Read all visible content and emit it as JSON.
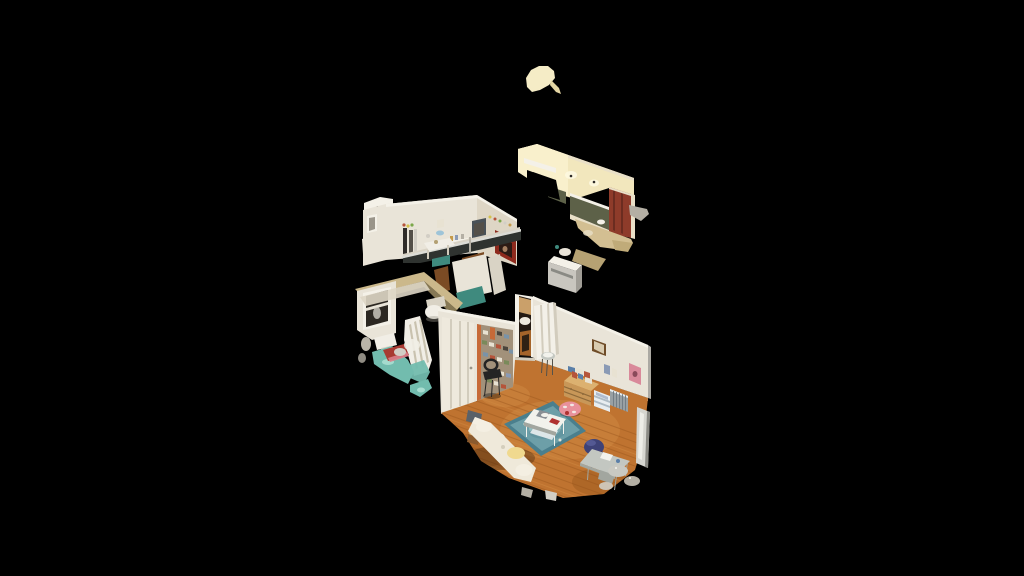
{
  "viewer": {
    "name": "3D dollhouse tour viewer",
    "background": "#000000"
  },
  "scene": {
    "type": "dollhouse-3d-scan",
    "description": "Cutaway dollhouse 3D scan of an apartment floating on a black void, viewed from above at an angle",
    "rooms": [
      {
        "id": "hallway",
        "label": "entry hallway",
        "features": [
          "warm lit cream wall",
          "olive-green wainscot",
          "red entry door",
          "tan floor"
        ]
      },
      {
        "id": "kitchen",
        "label": "kitchen",
        "features": [
          "white walls with shelves and clutter",
          "red skull poster",
          "stainless counter rail",
          "wood cabinet",
          "teal counter"
        ]
      },
      {
        "id": "bathroom",
        "label": "bathroom",
        "features": [
          "khaki wall tops",
          "window",
          "white toilet and sink",
          "shower curtain",
          "teal tile floor",
          "red bath mat"
        ]
      },
      {
        "id": "living-room",
        "label": "living room",
        "features": [
          "honey hardwood floor",
          "blue patterned rug",
          "white coffee table",
          "white daybed sofa",
          "pink pouf",
          "navy desk chair",
          "desk",
          "wood dresser",
          "radiator",
          "photo collage wall",
          "black chair",
          "white paneled doors",
          "leaning mirror"
        ]
      }
    ],
    "floating_fragments": [
      "cream ceiling blob above hallway",
      "white wall sliver left of bathroom",
      "small gray scraps below living room"
    ]
  },
  "palette": {
    "black": "#000000",
    "blob": "#f5ecc6",
    "blobShade": "#e4d6a4",
    "hallWall": "#f2e7bd",
    "hallLit": "#f9f0cc",
    "hallGlow": "#fdf8e0",
    "olive": "#5d6148",
    "doorRed": "#8e3b2a",
    "doorRedDark": "#6b2c20",
    "trimCream": "#e9e0c8",
    "hallFloor": "#d3bf92",
    "hallFloorShade": "#c0ab79",
    "grayFrag": "#b4afa4",
    "grayLight": "#d2cec5",
    "applianceGray": "#c9c6bf",
    "applianceSide": "#a09d96",
    "wallWhite": "#e9e4d8",
    "wallBright": "#f4f1e8",
    "wallShade": "#ded6c5",
    "tanTop": "#cbb88b",
    "tanShade": "#b3a072",
    "posterRed": "#8e2a1d",
    "posterDark": "#2c1b15",
    "posterFace": "#b98f6d",
    "frameGray": "#9a958a",
    "darkItem": "#2e2b28",
    "midGray": "#545049",
    "dotYellow": "#d4c24a",
    "dotGreen": "#7ba84a",
    "accentRed": "#b5543a",
    "bowlBlue": "#9ec4d8",
    "shelfWood": "#c49a4a",
    "slateBlue": "#8a9ab5",
    "applianceDark": "#4a5258",
    "rail": "#dcdcd6",
    "counterDark": "#2f3330",
    "tealCounter": "#3f8a7e",
    "woodCab": "#7b4b24",
    "windowDark": "#2c2822",
    "fixtureWhite": "#f1eee6",
    "fixtureShade": "#d9d3c5",
    "curtainFold": "#c9c2af",
    "tealFloor": "#72bcae",
    "tealLight": "#aaded2",
    "matRed": "#a83a32",
    "matPink": "#d9808a",
    "doorWhite": "#eee9dd",
    "doorBright": "#f3f0e8",
    "doorLine": "#d2ccbd",
    "collageBase": "#a2917a",
    "collageOrange": "#c76a38",
    "photoWhite": "#e8e2d2",
    "photoDark": "#4a443c",
    "photoBlue": "#7a93a8",
    "photoGreen": "#7a8a5a",
    "doorwayDark": "#241a12",
    "doorwayGlow": "#caa06a",
    "doorwayFloor": "#a5642a",
    "lrFloor": "#bf7330",
    "lrFloorLight": "#d08a42",
    "lrFloorDark": "#96541c",
    "rug": "#6d9fa8",
    "rugDark": "#4a7f8d",
    "rugLight": "#9cc4c4",
    "laptopGray": "#8a8f94",
    "poufPink": "#e8919b",
    "poufRed": "#b03230",
    "sofaWhite": "#efe9da",
    "sofaCush": "#f4efe2",
    "sofaWarm": "#f0d98f",
    "bagGray": "#5a6168",
    "stumpWood": "#8a5a2e",
    "chairBlue": "#3e4277",
    "chairBlueDark": "#2f3260",
    "chairBlueLight": "#5a5f9a",
    "deskTop": "#c3c7c1",
    "deskEdge": "#a2a69f",
    "paperWhite": "#f2f2ec",
    "itemBlue": "#5a7fa8",
    "dresser": "#c89758",
    "dresserTop": "#dcb170",
    "dresserLine": "#8f6a3a",
    "drawersWhite": "#e8edf0",
    "drawersLine": "#aebbc4",
    "radiator": "#98a0a4",
    "radiatorLine": "#737d85",
    "frameBrown": "#6f4c28",
    "frameInner": "#d8cbb0",
    "pinkArt": "#d9899a",
    "pinkArtDark": "#8a4a5a",
    "mirror": "#d6d6d0",
    "mirrorEdge": "#8a8a84",
    "foil": "#c9c9c2",
    "stoolLeg": "#55524a",
    "chairBlack": "#242424"
  }
}
